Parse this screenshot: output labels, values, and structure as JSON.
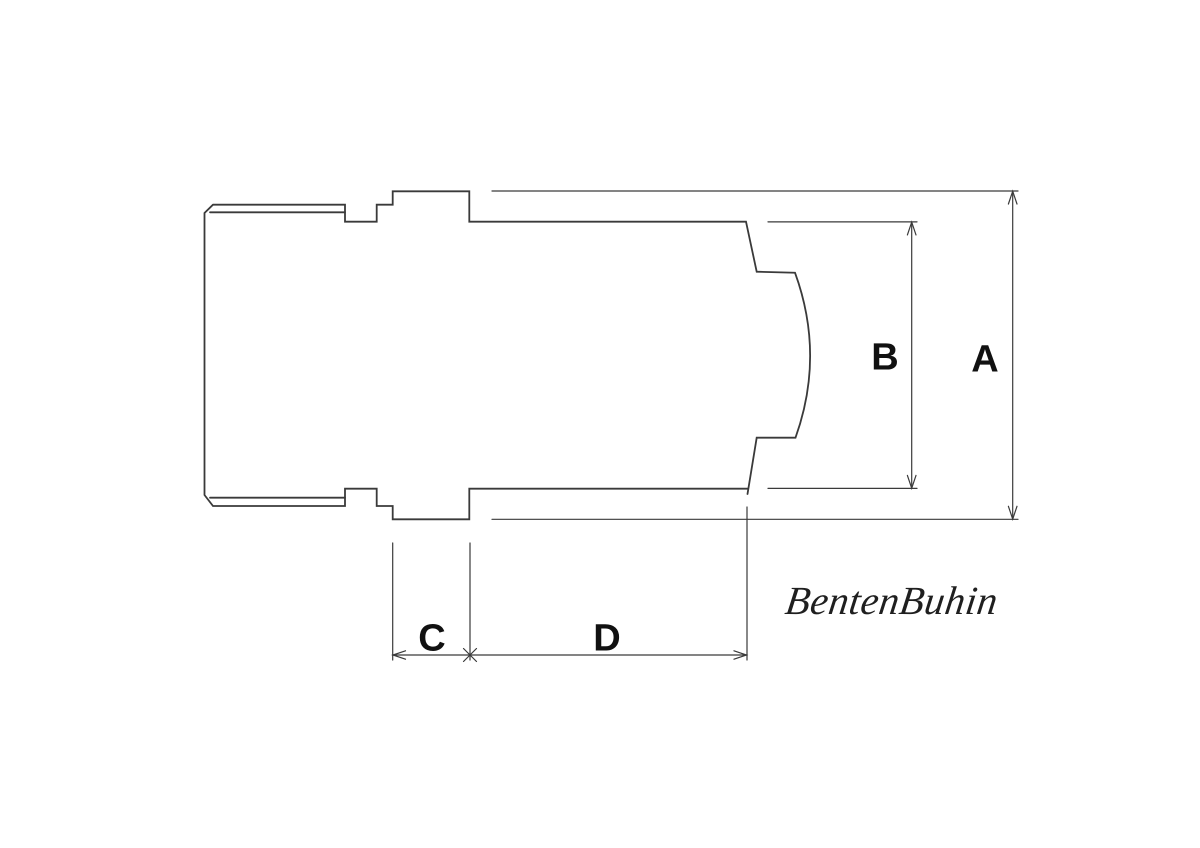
{
  "drawing": {
    "labels": {
      "a": "A",
      "b": "B",
      "c": "C",
      "d": "D"
    },
    "signature": "BentenBuhin",
    "colors": {
      "background": "#ffffff",
      "lines": "#3a3a3a",
      "labels": "#111111",
      "signature": "#1f1f1f"
    }
  }
}
